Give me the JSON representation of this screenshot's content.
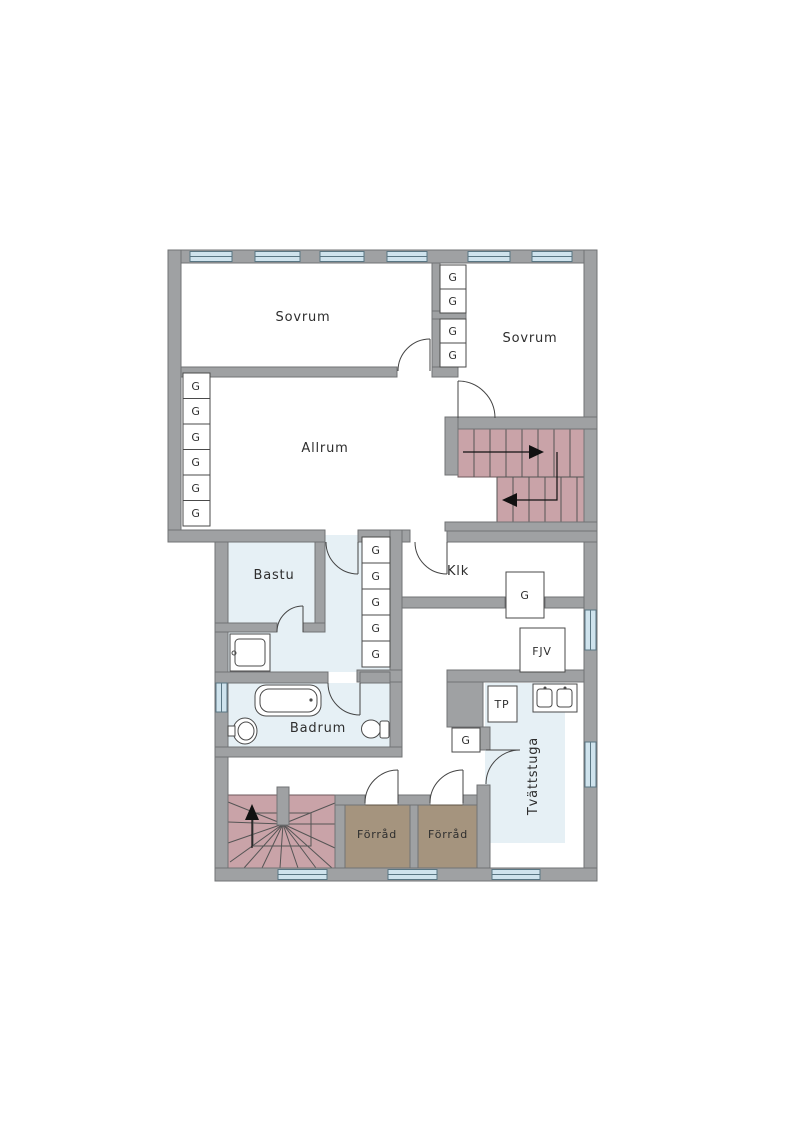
{
  "floorplan": {
    "rooms": [
      {
        "id": "sovrum-1",
        "label": "Sovrum",
        "floor": "white"
      },
      {
        "id": "sovrum-2",
        "label": "Sovrum",
        "floor": "white"
      },
      {
        "id": "allrum",
        "label": "Allrum",
        "floor": "white"
      },
      {
        "id": "bastu",
        "label": "Bastu",
        "floor": "wet-room-blue"
      },
      {
        "id": "klk",
        "label": "Klk",
        "floor": "white"
      },
      {
        "id": "badrum",
        "label": "Badrum",
        "floor": "wet-room-blue"
      },
      {
        "id": "tvattstuga",
        "label": "Tvättstuga",
        "floor": "wet-room-blue"
      },
      {
        "id": "forrad-1",
        "label": "Förråd",
        "floor": "storage-tan"
      },
      {
        "id": "forrad-2",
        "label": "Förråd",
        "floor": "storage-tan"
      }
    ],
    "fixtures": {
      "wardrobe_label": "G",
      "fjv_label": "FJV",
      "tp_label": "TP"
    },
    "wardrobes": {
      "allrum_left_column": 6,
      "bedroom_divider_column": 4,
      "corridor_column": 5,
      "klk_closet": 1,
      "tvattstuga_closet": 1,
      "total": 17
    },
    "stairs": [
      {
        "id": "stairs-upper-right",
        "type": "straight-double-flight",
        "color": "rose"
      },
      {
        "id": "stairs-lower-left",
        "type": "winder-fan",
        "color": "rose"
      }
    ],
    "windows": {
      "top_wall": 6,
      "bottom_wall": 3,
      "left_wall": 1,
      "right_wall": 2
    },
    "colors": {
      "wall": "#9fa1a3",
      "floor": "#ffffff",
      "wet_room_floor": "#e6f0f5",
      "stair_fill": "#c9a3a8",
      "storage_fill": "#a5947e",
      "window_fill": "#cfe3ed"
    }
  }
}
